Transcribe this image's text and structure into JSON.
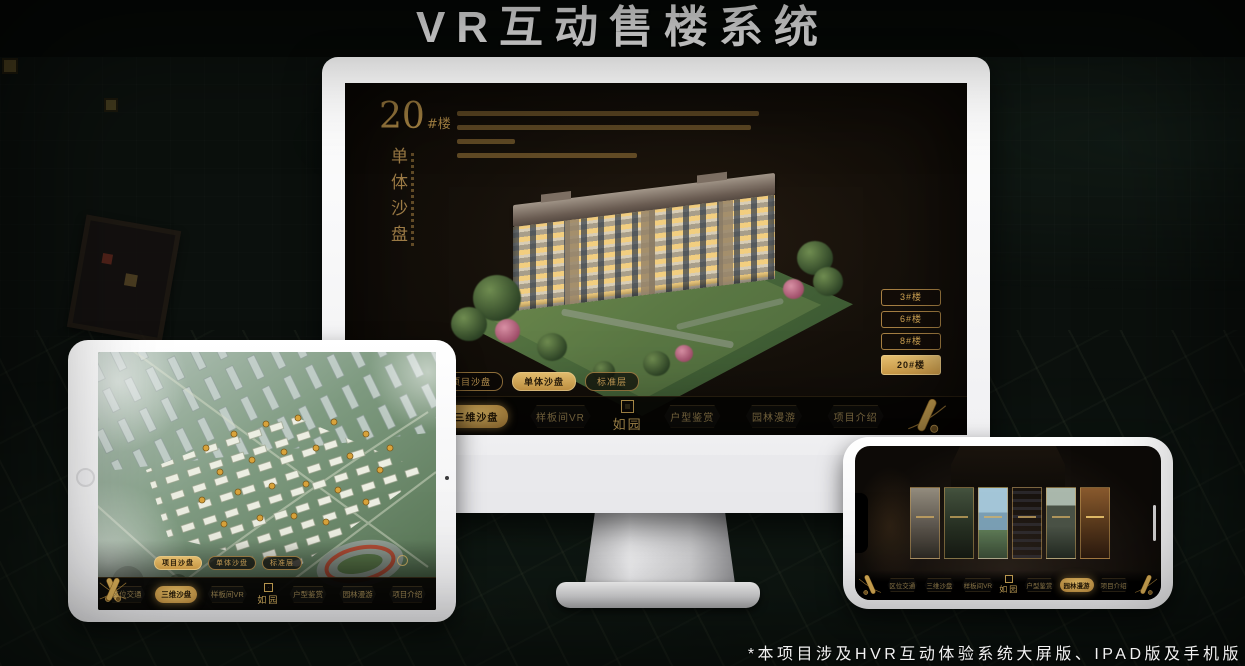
{
  "page": {
    "title": "VR互动售楼系统",
    "footnote": "*本项目涉及HVR互动体验系统大屏版、IPAD版及手机版"
  },
  "colors": {
    "gold": "#c99e52",
    "gold_bright": "#eec673",
    "active_pill": "#d6a24a",
    "screen_bg": "#15100a",
    "title_text": "#fafafa"
  },
  "monitor": {
    "heading": {
      "number": "20",
      "suffix": "#楼",
      "subtitle": "单体沙盘"
    },
    "floor_buttons": [
      {
        "label": "3#楼",
        "active": false
      },
      {
        "label": "6#楼",
        "active": false
      },
      {
        "label": "8#楼",
        "active": false
      },
      {
        "label": "20#楼",
        "active": true
      }
    ],
    "view_tabs": [
      {
        "label": "项目沙盘",
        "active": false
      },
      {
        "label": "单体沙盘",
        "active": true
      },
      {
        "label": "标准层",
        "active": false
      }
    ],
    "nav": {
      "logo": "如园",
      "items": [
        {
          "label": "区位交通",
          "active": false
        },
        {
          "label": "三维沙盘",
          "active": true
        },
        {
          "label": "样板间VR",
          "active": false
        },
        {
          "label": "户型鉴赏",
          "active": false
        },
        {
          "label": "园林漫游",
          "active": false
        },
        {
          "label": "项目介绍",
          "active": false
        }
      ]
    }
  },
  "ipad": {
    "view_tabs": [
      {
        "label": "项目沙盘",
        "active": true
      },
      {
        "label": "单体沙盘",
        "active": false
      },
      {
        "label": "标准层",
        "active": false
      }
    ],
    "nav": {
      "logo": "如园",
      "items": [
        {
          "label": "区位交通",
          "active": false
        },
        {
          "label": "三维沙盘",
          "active": true
        },
        {
          "label": "样板间VR",
          "active": false
        },
        {
          "label": "户型鉴赏",
          "active": false
        },
        {
          "label": "园林漫游",
          "active": false
        },
        {
          "label": "项目介绍",
          "active": false
        }
      ]
    }
  },
  "phone": {
    "nav": {
      "logo": "如园",
      "items": [
        {
          "label": "区位交通",
          "active": false
        },
        {
          "label": "三维沙盘",
          "active": false
        },
        {
          "label": "样板间VR",
          "active": false
        },
        {
          "label": "户型鉴赏",
          "active": false
        },
        {
          "label": "园林漫游",
          "active": true
        },
        {
          "label": "项目介绍",
          "active": false
        }
      ]
    }
  }
}
